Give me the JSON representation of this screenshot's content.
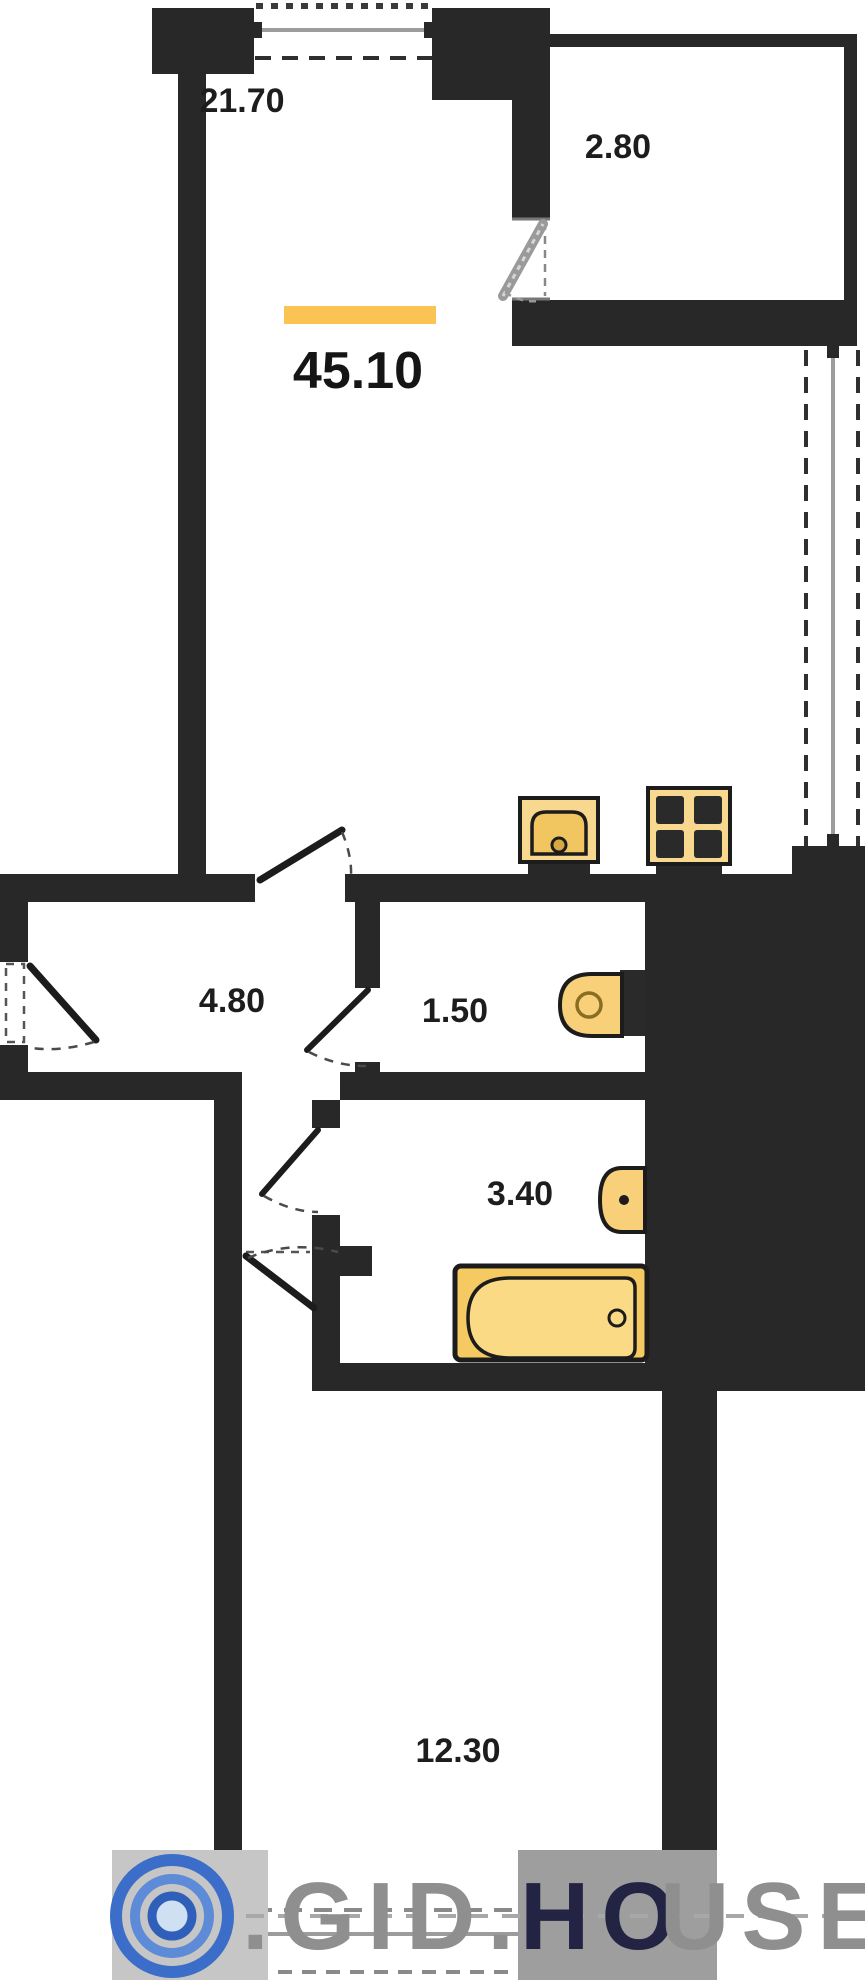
{
  "plan": {
    "type": "apartment-floor-plan",
    "total_area": "45.10",
    "rooms": {
      "living_kitchen": {
        "label": "21.70"
      },
      "balcony": {
        "label": "2.80"
      },
      "hallway": {
        "label": "4.80"
      },
      "wc": {
        "label": "1.50"
      },
      "bathroom": {
        "label": "3.40"
      },
      "bedroom": {
        "label": "12.30"
      }
    },
    "fixtures": [
      "kitchen-sink-icon",
      "stove-4-burner-icon",
      "toilet-icon",
      "washbasin-icon",
      "bathtub-icon"
    ],
    "colors": {
      "wall": "#282828",
      "fixture_fill": "#f8d88e",
      "fixture_accent": "#f1c660",
      "area_bar": "#fbc254",
      "window_gray": "#9c9c9c",
      "logo_blue": "#3b6dc9",
      "watermark_gray": "#8f8f8f",
      "watermark_dark": "#232343"
    }
  },
  "watermark": {
    "part1": ".GID.",
    "part2": "HO",
    "part3": "USE"
  }
}
